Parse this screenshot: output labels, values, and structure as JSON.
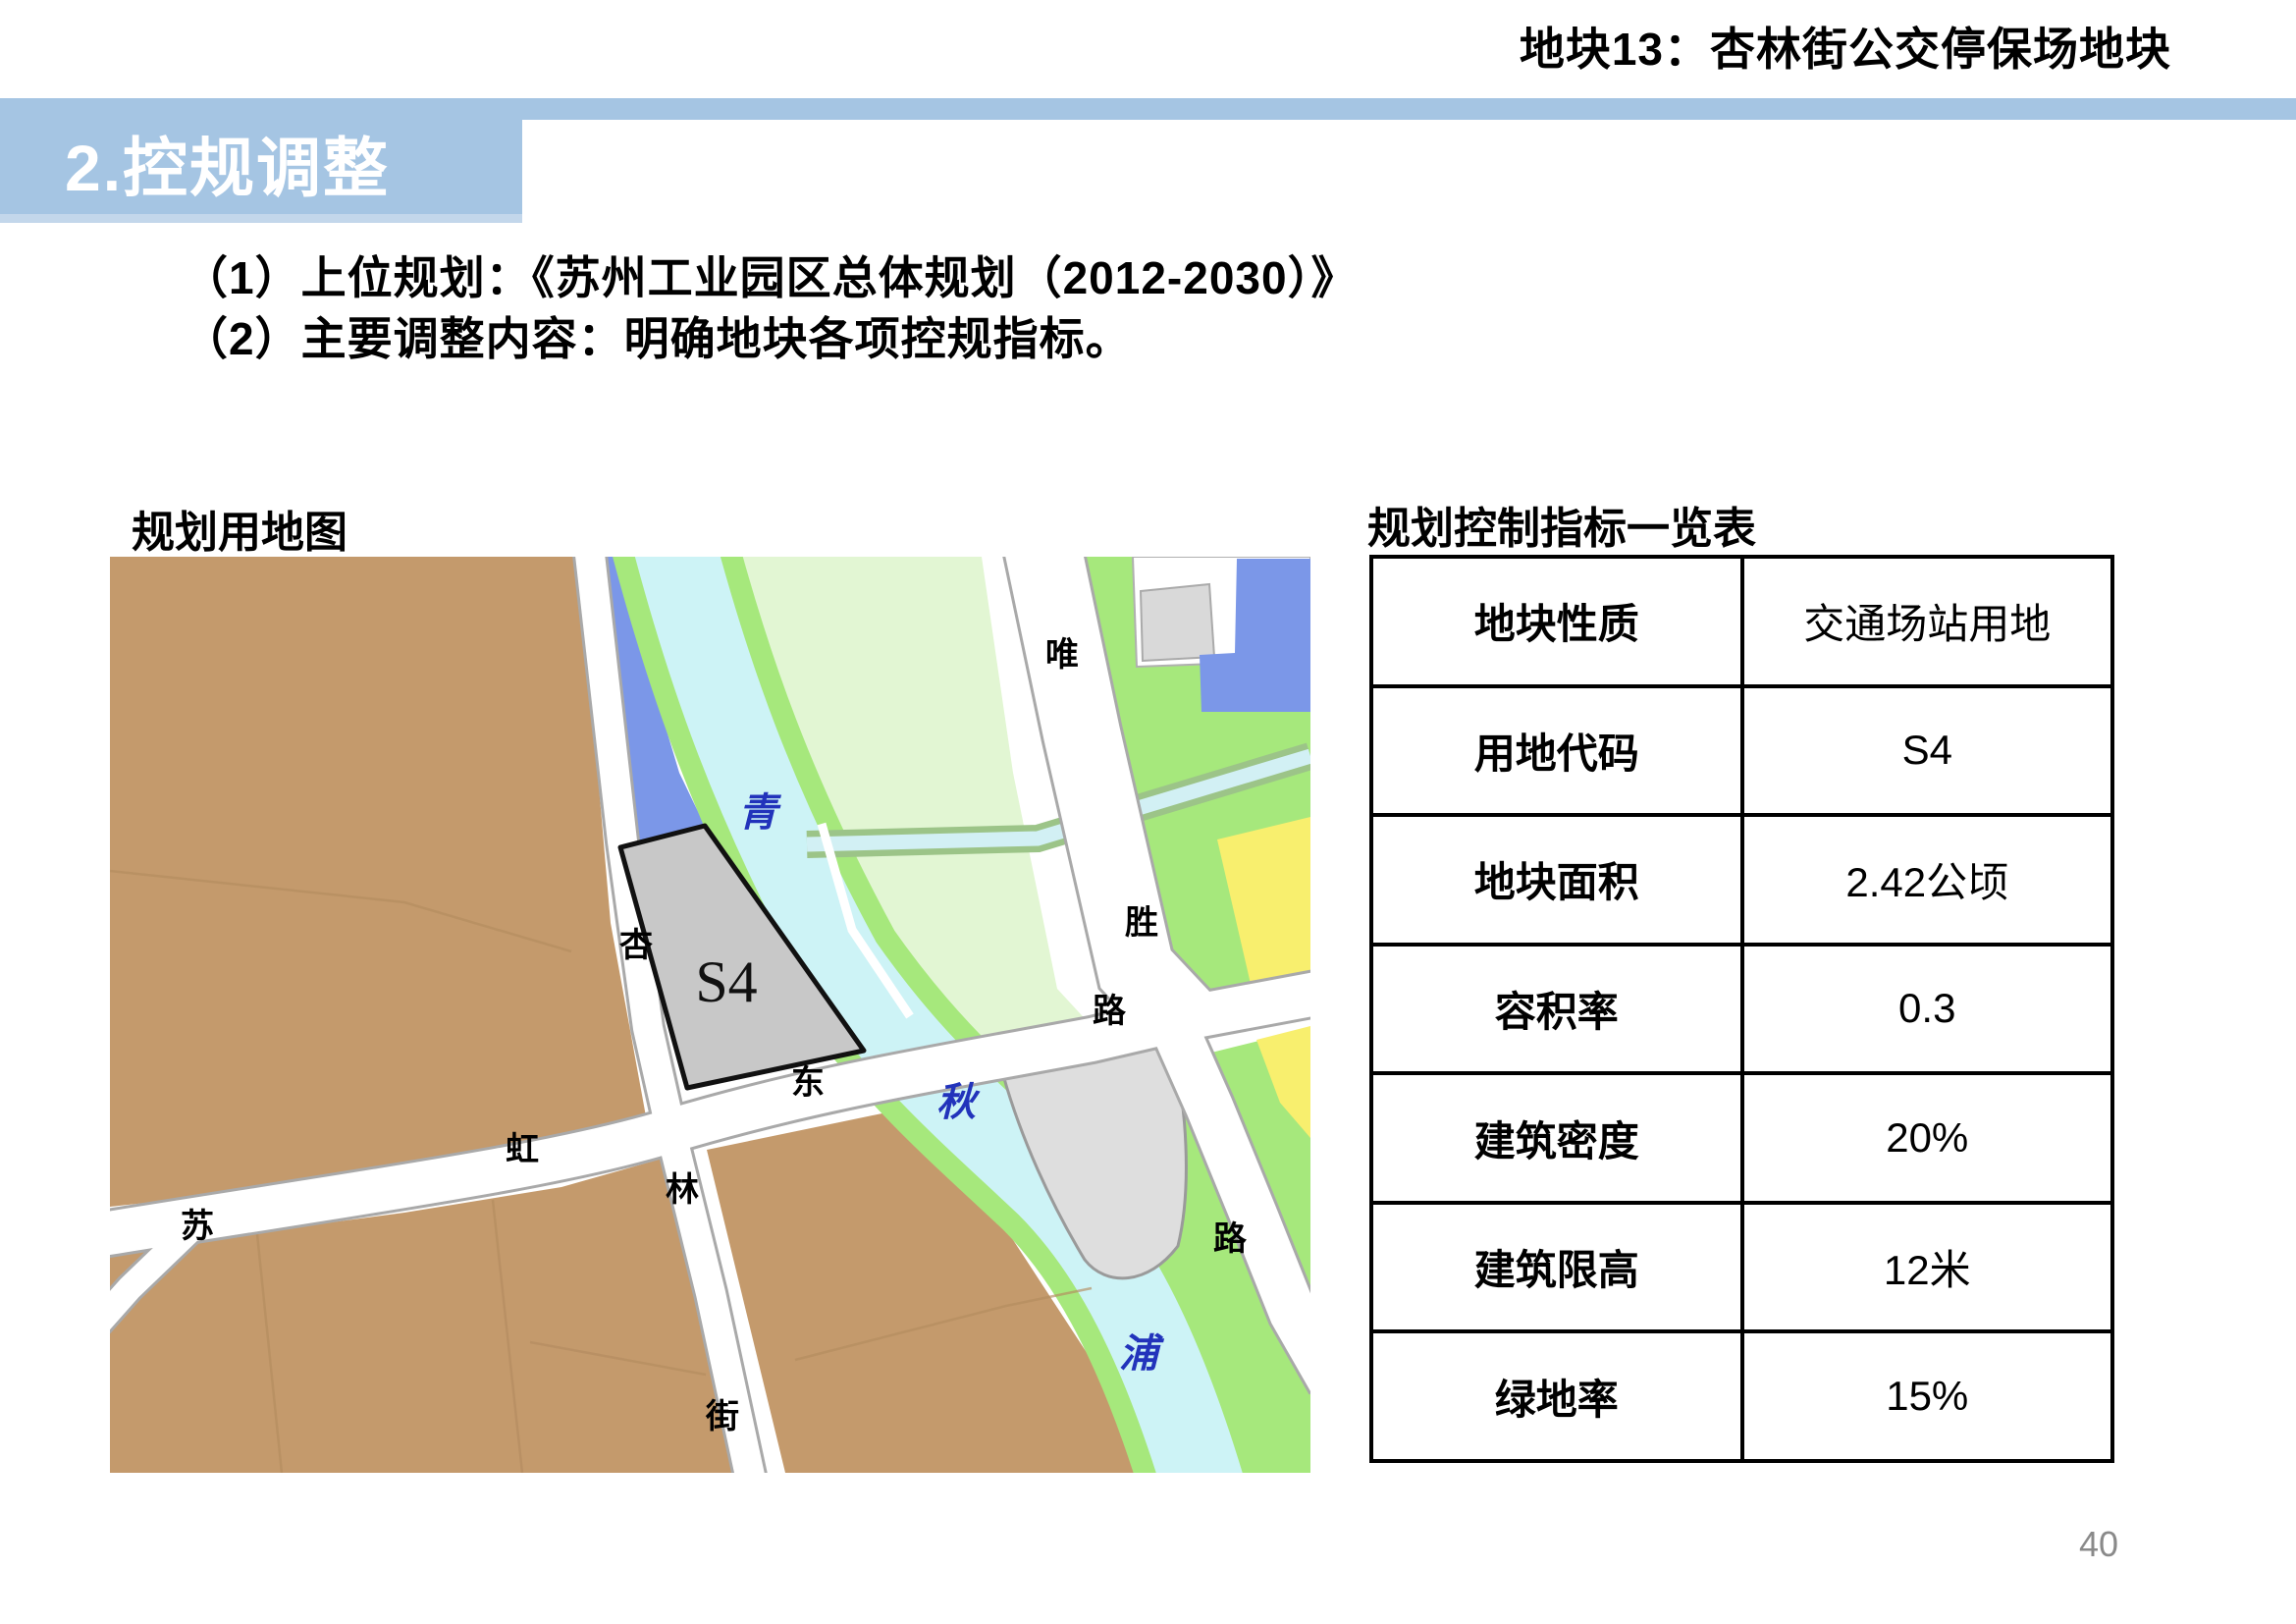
{
  "header": {
    "title": "地块13：杏林街公交停保场地块",
    "section_banner": "2.控规调整"
  },
  "body": {
    "line1": "（1）上位规划：《苏州工业园区总体规划（2012-2030）》",
    "line2": "（2）主要调整内容：明确地块各项控规指标。"
  },
  "map": {
    "label": "规划用地图",
    "plot_code": "S4",
    "labels": {
      "qing": "青",
      "qiu": "秋",
      "pu": "浦",
      "wei": "唯",
      "sheng": "胜",
      "lu1": "路",
      "lu2": "路",
      "xing": "杏",
      "lin": "林",
      "jie": "街",
      "su": "苏",
      "hong": "虹",
      "dong": "东"
    }
  },
  "table": {
    "label": "规划控制指标一览表",
    "rows": [
      {
        "name": "地块性质",
        "value": "交通场站用地"
      },
      {
        "name": "用地代码",
        "value": "S4"
      },
      {
        "name": "地块面积",
        "value": "2.42公顷"
      },
      {
        "name": "容积率",
        "value": "0.3"
      },
      {
        "name": "建筑密度",
        "value": "20%"
      },
      {
        "name": "建筑限高",
        "value": "12米"
      },
      {
        "name": "绿地率",
        "value": "15%"
      }
    ]
  },
  "footer": {
    "page_number": "40"
  },
  "colors": {
    "banner": "#a5c5e3",
    "banner_strip": "#c3d7eb",
    "pagenum": "#8a8a8a",
    "brown": "#c49a6c",
    "water": "#cdf3f6",
    "bank_green": "#a6e87c",
    "pale_green": "#e2f6d3",
    "blue_plot": "#7b97e8",
    "yellow_plot": "#f8ef6e",
    "gray_plot": "#dedede",
    "s4_gray": "#c8c8c8",
    "road_white": "#ffffff",
    "road_casing": "#a9a9a9"
  }
}
